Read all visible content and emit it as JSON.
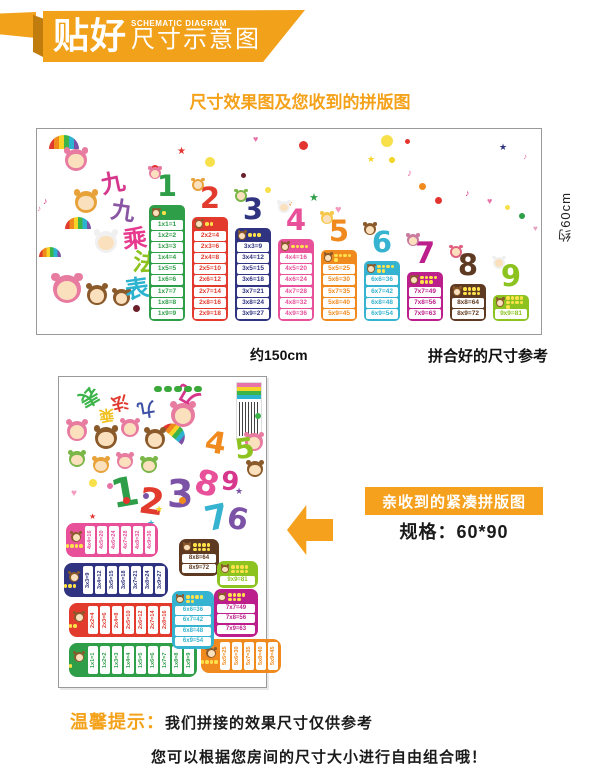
{
  "header": {
    "title_bold": "贴好",
    "subtitle_en": "SCHEMATIC DIAGRAM",
    "subtitle_cn": "尺寸示意图"
  },
  "section_title": "尺寸效果图及您收到的拼版图",
  "poster_title_chars": [
    "九",
    "九",
    "乘",
    "法",
    "表"
  ],
  "size_chart": {
    "height_label": "约60cm",
    "width_label": "约150cm",
    "caption": "拼合好的尺寸参考",
    "columns": [
      {
        "number": "1",
        "color": "#2e9e48",
        "facts": [
          "1x1=1",
          "1x2=2",
          "1x3=3",
          "1x4=4",
          "1x5=5",
          "1x6=6",
          "1x7=7",
          "1x8=8",
          "1x9=9"
        ]
      },
      {
        "number": "2",
        "color": "#e23b2e",
        "facts": [
          "2x2=4",
          "2x3=6",
          "2x4=8",
          "2x5=10",
          "2x6=12",
          "2x7=14",
          "2x8=16",
          "2x9=18"
        ]
      },
      {
        "number": "3",
        "color": "#2f3380",
        "facts": [
          "3x3=9",
          "3x4=12",
          "3x5=15",
          "3x6=18",
          "3x7=21",
          "3x8=24",
          "3x9=27"
        ]
      },
      {
        "number": "4",
        "color": "#e8509a",
        "facts": [
          "4x4=16",
          "4x5=20",
          "4x6=24",
          "4x7=28",
          "4x8=32",
          "4x9=36"
        ]
      },
      {
        "number": "5",
        "color": "#f18a1e",
        "facts": [
          "5x5=25",
          "5x6=30",
          "5x7=35",
          "5x8=40",
          "5x9=45"
        ]
      },
      {
        "number": "6",
        "color": "#35b3d0",
        "facts": [
          "6x6=36",
          "6x7=42",
          "6x8=48",
          "6x9=54"
        ]
      },
      {
        "number": "7",
        "color": "#bc1f8b",
        "facts": [
          "7x7=49",
          "7x8=56",
          "7x9=63"
        ]
      },
      {
        "number": "8",
        "color": "#5f3a22",
        "facts": [
          "8x8=64",
          "8x9=72"
        ]
      },
      {
        "number": "9",
        "color": "#8cc320",
        "facts": [
          "9x9=81"
        ]
      }
    ]
  },
  "compact": {
    "callout_label": "亲收到的紧凑拼版图",
    "spec_label": "规格：60*90",
    "scatter_numbers": [
      {
        "n": "1",
        "color": "#2e9e48"
      },
      {
        "n": "2",
        "color": "#e23b2e"
      },
      {
        "n": "3",
        "color": "#7b52a5"
      },
      {
        "n": "4",
        "color": "#f18a1e"
      },
      {
        "n": "5",
        "color": "#8cc320"
      },
      {
        "n": "6",
        "color": "#7b52a5"
      },
      {
        "n": "7",
        "color": "#35b3d0"
      },
      {
        "n": "8",
        "color": "#e8509a"
      },
      {
        "n": "9",
        "color": "#d6368b"
      }
    ]
  },
  "tips": {
    "prefix": "温馨提示：",
    "line1": "我们拼接的效果尺寸仅供参考",
    "line2": "您可以根据您房间的尺寸大小进行自由组合哦！"
  },
  "icons": {
    "star": "★",
    "heart": "♥",
    "note": "♪",
    "dot": "●"
  },
  "colors": {
    "accent_orange": "#f5a11d",
    "title_char_colors": [
      "#d6368b",
      "#8a56a3",
      "#e73a8e",
      "#8dc21f",
      "#2bb3d0"
    ],
    "compact_title_char_colors": [
      "#3cb44a",
      "#e0392e",
      "#f0c020",
      "#3f51a5",
      "#d6368b"
    ]
  }
}
